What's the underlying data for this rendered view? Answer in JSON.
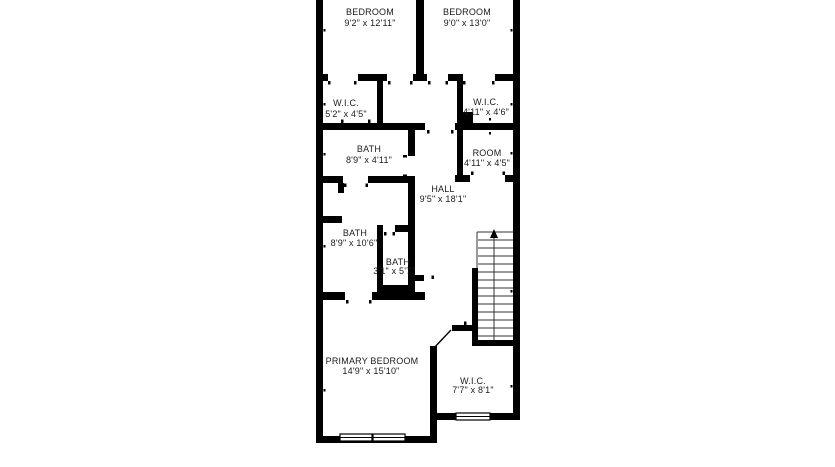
{
  "floor_plan": {
    "type": "residential-floorplan",
    "background_color": "#ffffff",
    "wall_color": "#000000",
    "text_color": "#1a1a1a",
    "rooms": [
      {
        "name": "BEDROOM",
        "dimensions": "9'2\" x 12'11\""
      },
      {
        "name": "BEDROOM",
        "dimensions": "9'0\" x 13'0\""
      },
      {
        "name": "W.I.C.",
        "dimensions": "5'2\" x 4'5\""
      },
      {
        "name": "W.I.C.",
        "dimensions": "4'11\" x 4'6\""
      },
      {
        "name": "BATH",
        "dimensions": "8'9\" x 4'11\""
      },
      {
        "name": "ROOM",
        "dimensions": "4'11\" x 4'5\""
      },
      {
        "name": "HALL",
        "dimensions": "9'5\" x 18'1\""
      },
      {
        "name": "BATH",
        "dimensions": "8'9\" x 10'6\""
      },
      {
        "name": "BATH",
        "dimensions": "3'1\" x 5'7\""
      },
      {
        "name": "PRIMARY BEDROOM",
        "dimensions": "14'9\" x 15'10\""
      },
      {
        "name": "W.I.C.",
        "dimensions": "7'7\" x 8'1\""
      }
    ],
    "features": {
      "stairs": {
        "location": "right-center",
        "direction_arrow": "up"
      },
      "windows": 3,
      "door_swing": 1,
      "shaft": "solid black block at right W.I.C. corner"
    }
  }
}
